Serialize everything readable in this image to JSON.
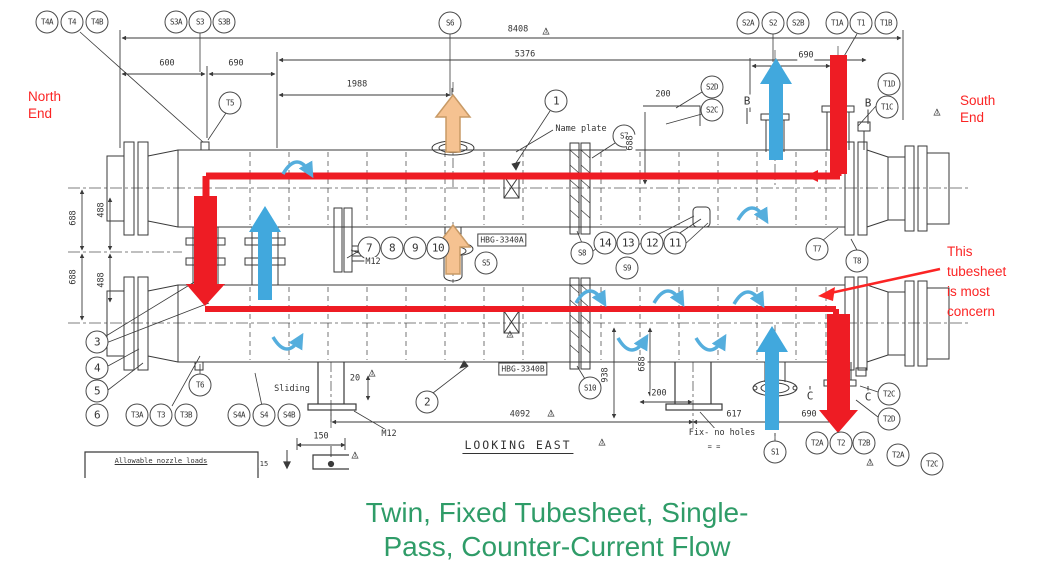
{
  "colors": {
    "hot": "#ee1c24",
    "cold": "#41a8dd",
    "swirl": "#55aedd",
    "warm": "#f5c291",
    "warmedge": "#c89a66",
    "ann": "#fb2424",
    "caption": "#2f9c68",
    "line": "#3a3a3a"
  },
  "icons": {
    "flag_triangle": "△"
  },
  "caption": {
    "text": "Twin, Fixed Tubesheet, Single-\nPass, Counter-Current Flow"
  },
  "annotations": {
    "north_end": "North\nEnd",
    "south_end": "South\nEnd",
    "concern": "This\ntubesheet\nis most\nconcern"
  },
  "equipment_tags": {
    "upper": "HBG-3340A",
    "lower": "HBG-3340B"
  },
  "view_label": "LOOKING EAST",
  "notes": {
    "name_plate": "Name plate",
    "sliding": "Sliding",
    "fix_no_holes": "Fix- no holes",
    "anchor_marks": "=   =",
    "allowable_loads": "Allowable nozzle loads",
    "stub": "15",
    "m12_upper": "M12",
    "m12_lower": "M12"
  },
  "callouts": [
    {
      "name": "callout-T4A",
      "label": "T4A",
      "x": 47,
      "y": 22
    },
    {
      "name": "callout-T4",
      "label": "T4",
      "x": 72,
      "y": 22
    },
    {
      "name": "callout-T4B",
      "label": "T4B",
      "x": 97,
      "y": 22
    },
    {
      "name": "callout-S3A",
      "label": "S3A",
      "x": 176,
      "y": 22
    },
    {
      "name": "callout-S3",
      "label": "S3",
      "x": 200,
      "y": 22
    },
    {
      "name": "callout-S3B",
      "label": "S3B",
      "x": 224,
      "y": 22
    },
    {
      "name": "callout-S6",
      "label": "S6",
      "x": 450,
      "y": 23
    },
    {
      "name": "callout-S2A",
      "label": "S2A",
      "x": 748,
      "y": 23
    },
    {
      "name": "callout-S2",
      "label": "S2",
      "x": 773,
      "y": 23
    },
    {
      "name": "callout-S2B",
      "label": "S2B",
      "x": 798,
      "y": 23
    },
    {
      "name": "callout-T1A",
      "label": "T1A",
      "x": 837,
      "y": 23
    },
    {
      "name": "callout-T1",
      "label": "T1",
      "x": 861,
      "y": 23
    },
    {
      "name": "callout-T1B",
      "label": "T1B",
      "x": 886,
      "y": 23
    },
    {
      "name": "callout-S2D",
      "label": "S2D",
      "x": 712,
      "y": 87
    },
    {
      "name": "callout-S2C",
      "label": "S2C",
      "x": 712,
      "y": 110
    },
    {
      "name": "callout-T1D",
      "label": "T1D",
      "x": 889,
      "y": 84
    },
    {
      "name": "callout-T1C",
      "label": "T1C",
      "x": 887,
      "y": 107
    },
    {
      "name": "callout-T5",
      "label": "T5",
      "x": 230,
      "y": 103
    },
    {
      "name": "callout-1",
      "label": "1",
      "x": 556,
      "y": 101,
      "cls": "num"
    },
    {
      "name": "callout-S7",
      "label": "S7",
      "x": 624,
      "y": 136
    },
    {
      "name": "callout-7",
      "label": "7",
      "x": 369,
      "y": 248,
      "cls": "num"
    },
    {
      "name": "callout-8",
      "label": "8",
      "x": 392,
      "y": 248,
      "cls": "num"
    },
    {
      "name": "callout-9",
      "label": "9",
      "x": 415,
      "y": 248,
      "cls": "num"
    },
    {
      "name": "callout-10",
      "label": "10",
      "x": 438,
      "y": 248,
      "cls": "num"
    },
    {
      "name": "callout-S5",
      "label": "S5",
      "x": 486,
      "y": 263
    },
    {
      "name": "callout-S8",
      "label": "S8",
      "x": 582,
      "y": 253
    },
    {
      "name": "callout-14",
      "label": "14",
      "x": 605,
      "y": 243,
      "cls": "num"
    },
    {
      "name": "callout-13",
      "label": "13",
      "x": 628,
      "y": 243,
      "cls": "num"
    },
    {
      "name": "callout-12",
      "label": "12",
      "x": 652,
      "y": 243,
      "cls": "num"
    },
    {
      "name": "callout-11",
      "label": "11",
      "x": 675,
      "y": 243,
      "cls": "num"
    },
    {
      "name": "callout-S9",
      "label": "S9",
      "x": 627,
      "y": 268
    },
    {
      "name": "callout-T7",
      "label": "T7",
      "x": 817,
      "y": 249
    },
    {
      "name": "callout-T8",
      "label": "T8",
      "x": 857,
      "y": 261
    },
    {
      "name": "callout-3",
      "label": "3",
      "x": 97,
      "y": 342,
      "cls": "num"
    },
    {
      "name": "callout-4",
      "label": "4",
      "x": 97,
      "y": 368,
      "cls": "num"
    },
    {
      "name": "callout-5",
      "label": "5",
      "x": 97,
      "y": 391,
      "cls": "num"
    },
    {
      "name": "callout-6",
      "label": "6",
      "x": 97,
      "y": 415,
      "cls": "num"
    },
    {
      "name": "callout-T6",
      "label": "T6",
      "x": 200,
      "y": 385
    },
    {
      "name": "callout-T3A",
      "label": "T3A",
      "x": 137,
      "y": 415
    },
    {
      "name": "callout-T3",
      "label": "T3",
      "x": 161,
      "y": 415
    },
    {
      "name": "callout-T3B",
      "label": "T3B",
      "x": 186,
      "y": 415
    },
    {
      "name": "callout-S4A",
      "label": "S4A",
      "x": 239,
      "y": 415
    },
    {
      "name": "callout-S4",
      "label": "S4",
      "x": 264,
      "y": 415
    },
    {
      "name": "callout-S4B",
      "label": "S4B",
      "x": 289,
      "y": 415
    },
    {
      "name": "callout-2",
      "label": "2",
      "x": 427,
      "y": 402,
      "cls": "num"
    },
    {
      "name": "callout-S10",
      "label": "S10",
      "x": 590,
      "y": 388
    },
    {
      "name": "callout-S1",
      "label": "S1",
      "x": 775,
      "y": 452
    },
    {
      "name": "callout-T2A",
      "label": "T2A",
      "x": 817,
      "y": 443
    },
    {
      "name": "callout-T2",
      "label": "T2",
      "x": 841,
      "y": 443
    },
    {
      "name": "callout-T2B",
      "label": "T2B",
      "x": 864,
      "y": 443
    },
    {
      "name": "callout-T2C",
      "label": "T2C",
      "x": 889,
      "y": 394
    },
    {
      "name": "callout-T2D",
      "label": "T2D",
      "x": 889,
      "y": 419
    },
    {
      "name": "callout-T2A-2",
      "label": "T2A",
      "x": 898,
      "y": 455
    },
    {
      "name": "callout-T2C-2",
      "label": "T2C",
      "x": 932,
      "y": 464
    }
  ],
  "dims": [
    {
      "name": "dim-8408",
      "t": "8408",
      "x": 518,
      "y": 30
    },
    {
      "name": "dim-5376",
      "t": "5376",
      "x": 525,
      "y": 55
    },
    {
      "name": "dim-600",
      "t": "600",
      "x": 167,
      "y": 64
    },
    {
      "name": "dim-690-left",
      "t": "690",
      "x": 236,
      "y": 64
    },
    {
      "name": "dim-1988",
      "t": "1988",
      "x": 357,
      "y": 85
    },
    {
      "name": "dim-690-right",
      "t": "690",
      "x": 806,
      "y": 56
    },
    {
      "name": "dim-200-topright",
      "t": "200",
      "x": 663,
      "y": 95
    },
    {
      "name": "dim-688-topright",
      "t": "688",
      "x": 631,
      "y": 143,
      "cls": "v"
    },
    {
      "name": "dim-688-upperleft",
      "t": "688",
      "x": 74,
      "y": 218,
      "cls": "v"
    },
    {
      "name": "dim-488-upperleft",
      "t": "488",
      "x": 102,
      "y": 210,
      "cls": "v"
    },
    {
      "name": "dim-688-lowerleft",
      "t": "688",
      "x": 74,
      "y": 277,
      "cls": "v"
    },
    {
      "name": "dim-488-lowerleft",
      "t": "488",
      "x": 102,
      "y": 280,
      "cls": "v"
    },
    {
      "name": "dim-938",
      "t": "938",
      "x": 606,
      "y": 375,
      "cls": "v"
    },
    {
      "name": "dim-688-bottomright",
      "t": "688",
      "x": 643,
      "y": 364,
      "cls": "v"
    },
    {
      "name": "dim-200-bottomright",
      "t": "200",
      "x": 659,
      "y": 394
    },
    {
      "name": "dim-20",
      "t": "20",
      "x": 355,
      "y": 379
    },
    {
      "name": "dim-150",
      "t": "150",
      "x": 321,
      "y": 437
    },
    {
      "name": "dim-4092",
      "t": "4092",
      "x": 520,
      "y": 415
    },
    {
      "name": "dim-617",
      "t": "617",
      "x": 734,
      "y": 415
    },
    {
      "name": "dim-690-bottom",
      "t": "690",
      "x": 809,
      "y": 415
    }
  ],
  "flags": [
    {
      "name": "flag-8408",
      "label": "1",
      "x": 546,
      "y": 30
    },
    {
      "name": "flag-southend",
      "label": "1",
      "x": 937,
      "y": 111
    },
    {
      "name": "flag-shell",
      "label": "1",
      "x": 510,
      "y": 333
    },
    {
      "name": "flag-support",
      "label": "1",
      "x": 372,
      "y": 372
    },
    {
      "name": "flag-4092",
      "label": "1",
      "x": 551,
      "y": 412
    },
    {
      "name": "flag-lookingeast",
      "label": "1",
      "x": 602,
      "y": 441
    },
    {
      "name": "flag-base-detail",
      "label": "1",
      "x": 355,
      "y": 454
    },
    {
      "name": "flag-t2",
      "label": "1",
      "x": 870,
      "y": 461
    }
  ],
  "marks": [
    {
      "name": "section-mark-B-1",
      "label": "B",
      "x": 747,
      "y": 101
    },
    {
      "name": "section-mark-B-2",
      "label": "B",
      "x": 868,
      "y": 103
    },
    {
      "name": "section-mark-C-1",
      "label": "C",
      "x": 810,
      "y": 396
    },
    {
      "name": "section-mark-C-2",
      "label": "C",
      "x": 868,
      "y": 397
    }
  ]
}
